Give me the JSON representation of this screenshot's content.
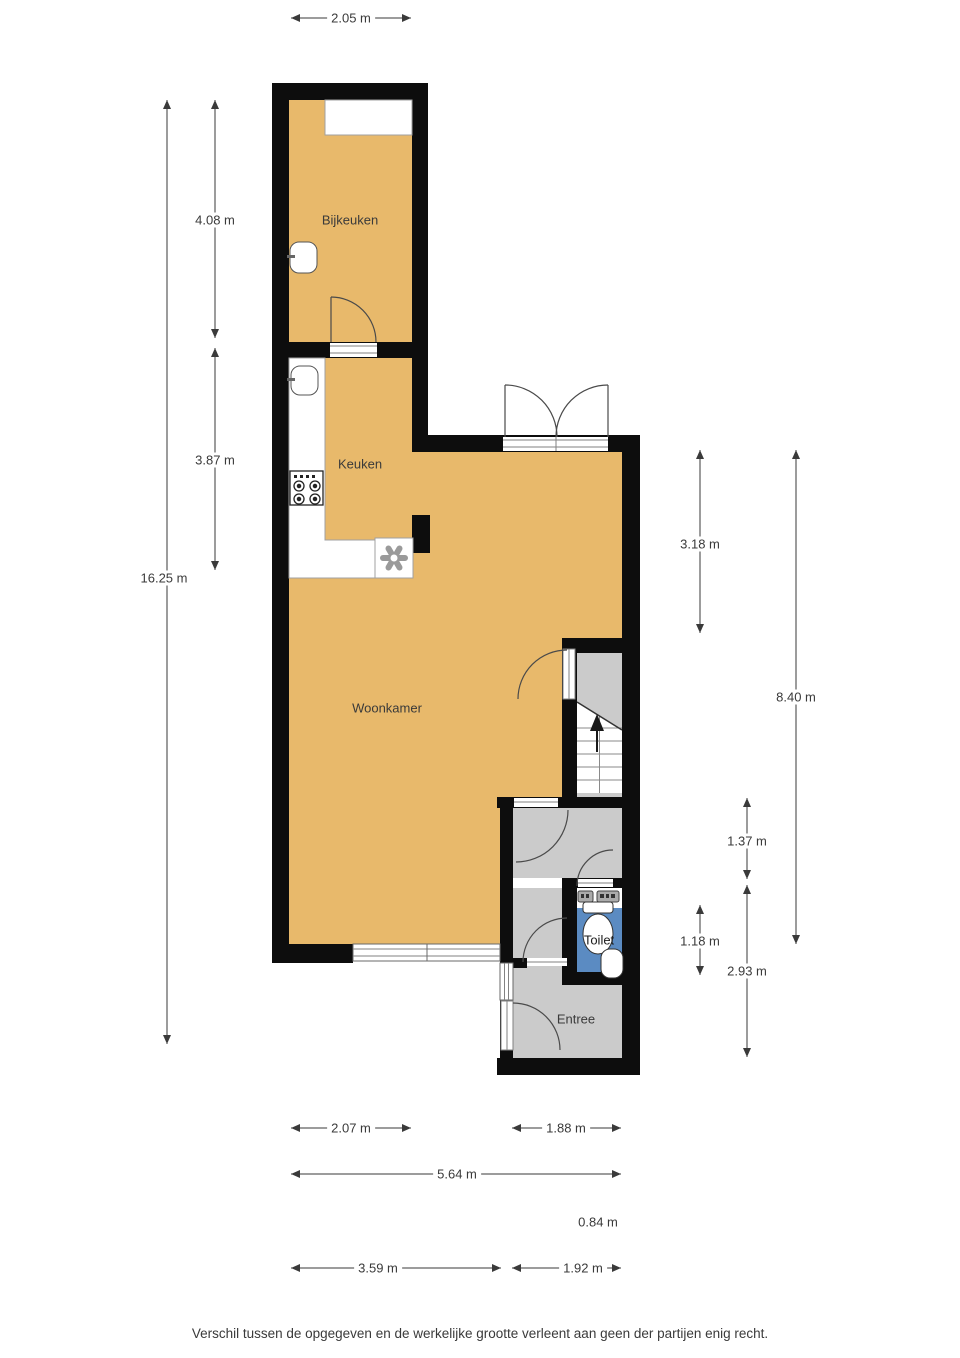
{
  "plan": {
    "title": "floor-plan",
    "rooms": {
      "bijkeuken": "Bijkeuken",
      "keuken": "Keuken",
      "woonkamer": "Woonkamer",
      "toilet": "Toilet",
      "entree": "Entree"
    },
    "dimensions": {
      "top_width": "2.05 m",
      "left_bijkeuken_height": "4.08 m",
      "left_keuken_height": "3.87 m",
      "left_total_height": "16.25 m",
      "right_upper_height": "3.18 m",
      "right_total_height": "8.40 m",
      "right_hall_height": "1.37 m",
      "right_toilet_height": "1.18 m",
      "right_lower_height": "2.93 m",
      "bottom_left_width": "2.07 m",
      "bottom_right_width": "1.88 m",
      "bottom_total_width": "5.64 m",
      "bottom_small_width": "0.84 m",
      "bottom_row2_left_width": "3.59 m",
      "bottom_row2_right_width": "1.92 m"
    },
    "footer_disclaimer": "Verschil tussen de opgegeven en de werkelijke grootte verleent aan geen der partijen enig recht.",
    "colors": {
      "wall": "#0d0d0d",
      "floor_main": "#e8b96b",
      "floor_hall": "#cbcbcb",
      "floor_toilet": "#5b8bc2",
      "dimension_text": "#3a3a3a"
    },
    "icons": {
      "stairs_up_arrow": "▲",
      "sink": "rounded-basin-shape",
      "stove": "four-burner-circles",
      "extractor_flower": "six-petal-asterisk",
      "toilet": "tank-and-bowl",
      "washbasin": "rounded-basin-shape",
      "meters": "wall-mounted-boxes"
    }
  }
}
